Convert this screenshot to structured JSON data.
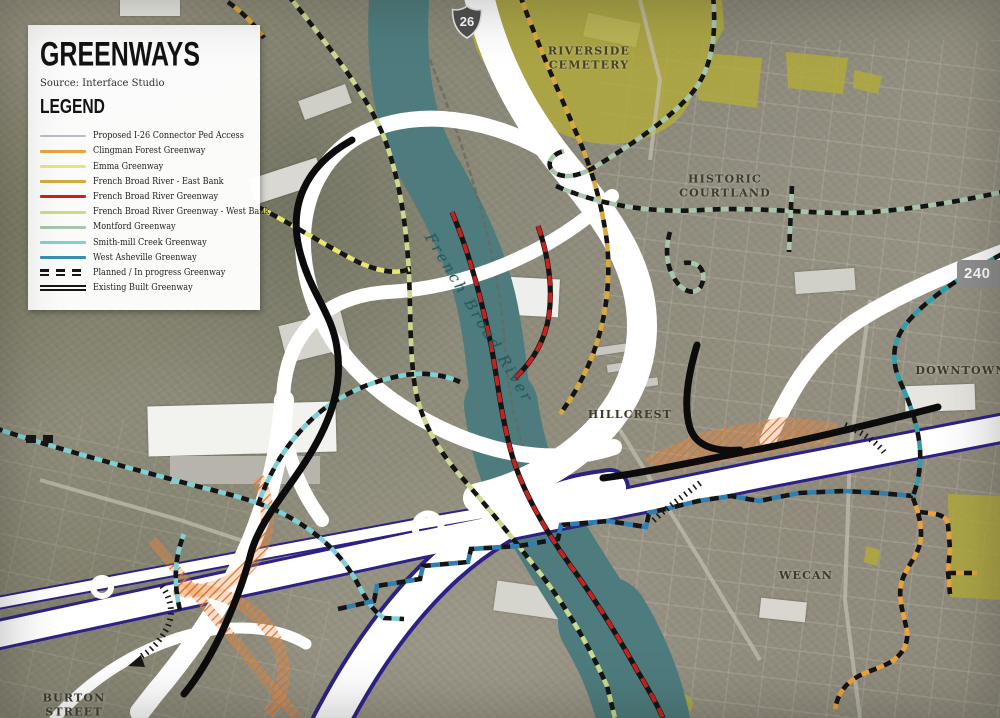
{
  "panel": {
    "title": "GREENWAYS",
    "source": "Source: Interface Studio",
    "legend_heading": "LEGEND",
    "items": [
      {
        "label": "Proposed I-26 Connector Ped Access",
        "color": "#b9bcc9",
        "style": "thin"
      },
      {
        "label": "Clingman Forest Greenway",
        "color": "#e8a33d",
        "style": "solid"
      },
      {
        "label": "Emma Greenway",
        "color": "#e9e66f",
        "style": "solid"
      },
      {
        "label": "French Broad River - East Bank",
        "color": "#d9a93c",
        "style": "solid"
      },
      {
        "label": "French Broad River Greenway",
        "color": "#c5231f",
        "style": "solid"
      },
      {
        "label": "French Broad River Greenway - West Bank",
        "color": "#cdd98e",
        "style": "solid"
      },
      {
        "label": "Montford Greenway",
        "color": "#a9c5ad",
        "style": "solid"
      },
      {
        "label": "Smith-mill Creek Greenway",
        "color": "#7fd0d4",
        "style": "solid"
      },
      {
        "label": "West Asheville Greenway",
        "color": "#3a8fb0",
        "style": "solid"
      },
      {
        "label": "Planned / In progress Greenway",
        "color": "#1a1a1a",
        "style": "double-dashed"
      },
      {
        "label": "Existing Built Greenway",
        "color": "#1a1a1a",
        "style": "double-solid"
      }
    ]
  },
  "map": {
    "labels": {
      "riverside": [
        "RIVERSIDE",
        "CEMETERY"
      ],
      "historic": [
        "HISTORIC",
        "COURTLAND"
      ],
      "downtown": "DOWNTOWN",
      "hillcrest": "HILLCREST",
      "wecan": "WECAN",
      "burton": [
        "BURTON",
        "STREET"
      ],
      "river": "French Broad River"
    },
    "shields": {
      "interstate": "26",
      "route": "240"
    },
    "colors": {
      "river": "#4e7c7e",
      "highway": "#ffffff",
      "highway_edge": "#2b2187",
      "park_olive": "#b2ab3b",
      "construction_orange": "#d9742e",
      "existing_greenway": "#0c0c0c"
    }
  }
}
